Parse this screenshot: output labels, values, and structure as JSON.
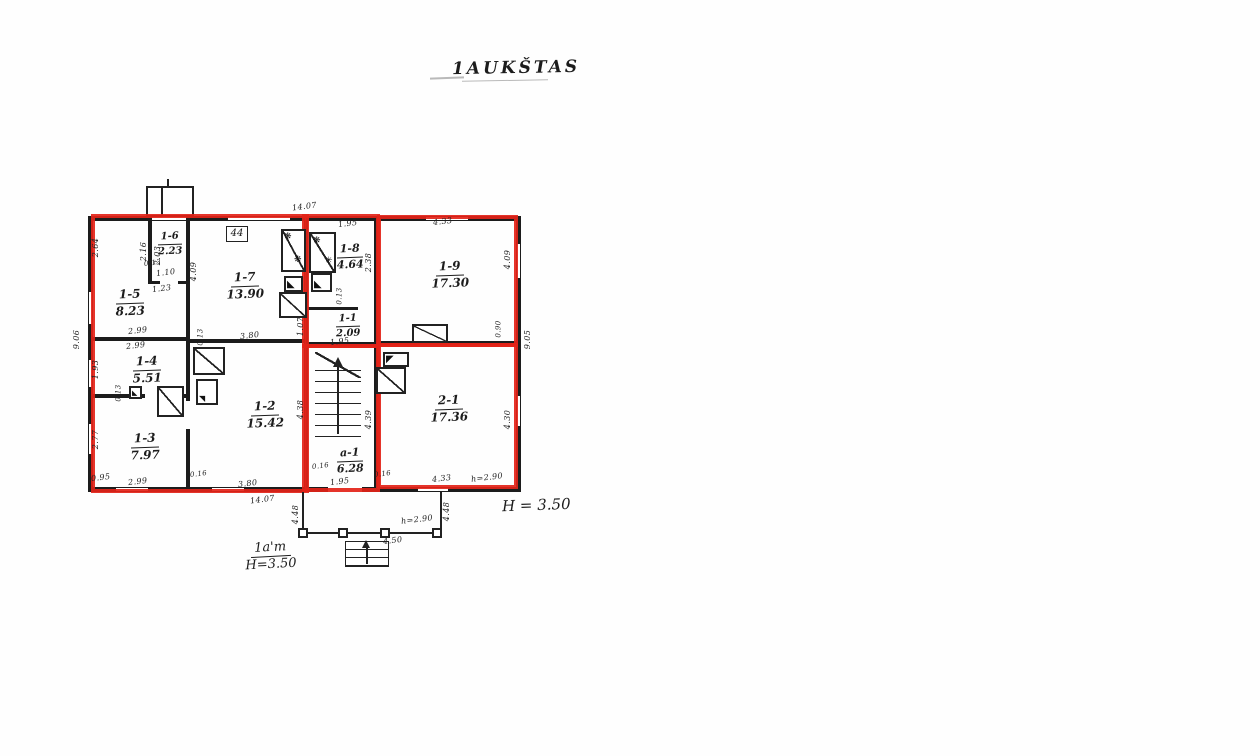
{
  "title": "1AUKŠTAS",
  "plan_box_label": "44",
  "height_note_right": "H = 3.50",
  "floor_note": {
    "top": "1a'm",
    "bottom": "H=3.50"
  },
  "colors": {
    "overlay": "#e32318",
    "ink": "#1c1c1c"
  },
  "rooms": [
    {
      "name": "1-6",
      "area": "2.23"
    },
    {
      "name": "1-5",
      "area": "8.23"
    },
    {
      "name": "1-7",
      "area": "13.90"
    },
    {
      "name": "1-8",
      "area": "4.64"
    },
    {
      "name": "1-9",
      "area": "17.30"
    },
    {
      "name": "1-4",
      "area": "5.51"
    },
    {
      "name": "1-1",
      "area": "2.09"
    },
    {
      "name": "1-2",
      "area": "15.42"
    },
    {
      "name": "a-1",
      "area": "6.28"
    },
    {
      "name": "1-3",
      "area": "7.97"
    },
    {
      "name": "2-1",
      "area": "17.36"
    }
  ],
  "dims": [
    "14.07",
    "1.95",
    "4.33",
    "2.16",
    "2.03",
    "0.13",
    "1.10",
    "1.23",
    "4.09",
    "2.64",
    "9.06",
    "2.99",
    "2.99",
    "1.93",
    "0.13",
    "2.77",
    "0.95",
    "2.99",
    "0.16",
    "0.13",
    "3.80",
    "3.80",
    "4.38",
    "0.13",
    "1.07",
    "1.95",
    "1.95",
    "4.39",
    "2.38",
    "4.09",
    "0.90",
    "9.05",
    "4.30",
    "4.33",
    "h=2.90",
    "14.07",
    "4.48",
    "4.48",
    "h=2.90",
    "4.50",
    "0.16",
    "0.16"
  ]
}
